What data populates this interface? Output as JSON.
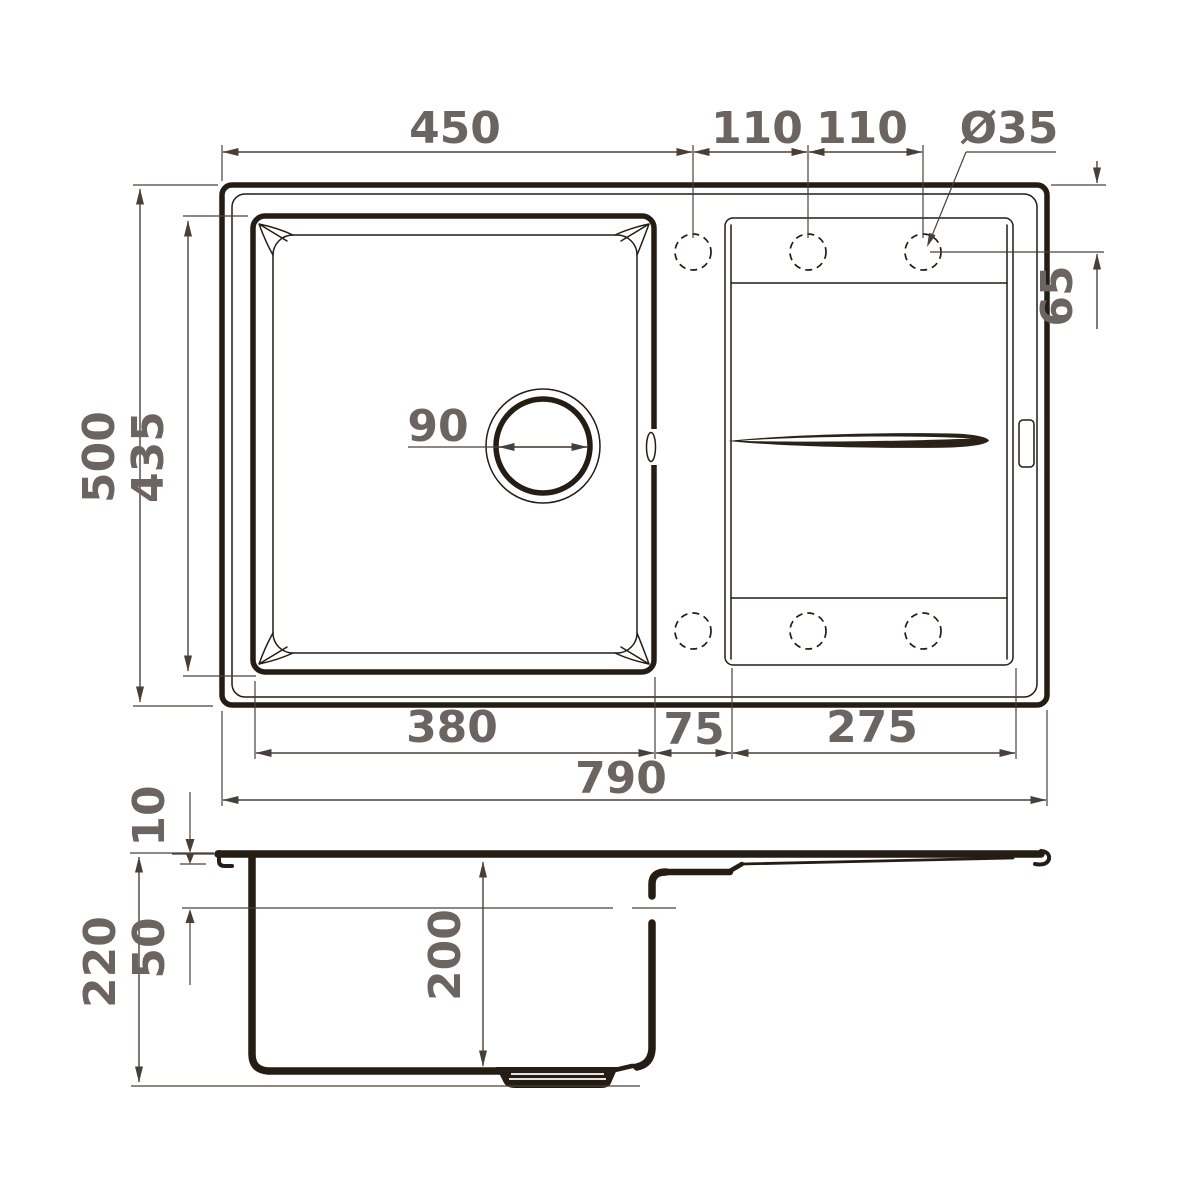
{
  "drawing": {
    "title": "sink-dimensional-drawing",
    "views": [
      "top-view",
      "side-section-view"
    ],
    "colors": {
      "outline": "#251c13",
      "dimension_lines": "#4a4139",
      "dimension_text": "#6b6461",
      "background": "#ffffff"
    },
    "units": "mm"
  },
  "sink": {
    "top_view": {
      "overall": {
        "width": "790",
        "depth": "500"
      },
      "bowl": {
        "width": "380",
        "depth": "435",
        "drain_diameter": "90"
      },
      "tap_holes": {
        "offset_from_left": "450",
        "pitch_1": "110",
        "pitch_2": "110",
        "diameter": "Ø35",
        "offset_from_top_edge": "65",
        "count_visible": 6
      },
      "gap_bowl_to_drainboard": "75",
      "drainboard_width": "275"
    },
    "side_view": {
      "overall_height": "220",
      "bowl_depth": "200",
      "rim_height": "10",
      "overflow_from_top": "50"
    }
  }
}
